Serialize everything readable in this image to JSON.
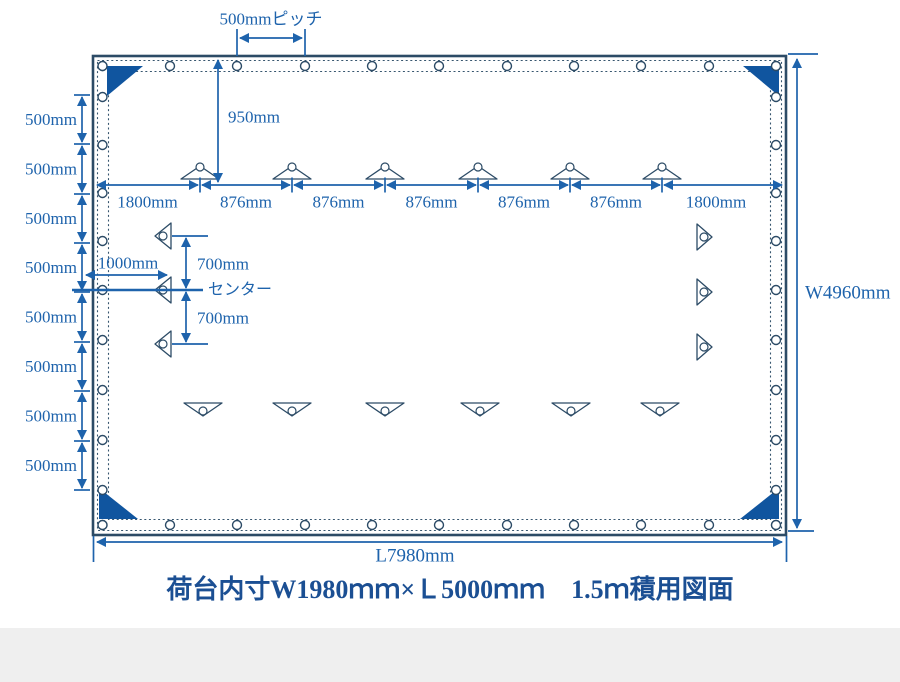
{
  "caption": {
    "text": "荷台内寸W1980ｍｍ×Ｌ5000ｍｍ　1.5ｍ積用図面"
  },
  "labels": {
    "pitch": "500mmピッチ",
    "drop": "950mm",
    "offset": "1000mm",
    "center": "センター",
    "width": "W4960mm",
    "length": "L7980mm"
  },
  "colors": {
    "outline": "#2c4b66",
    "dimension_blue": "#1e63ac",
    "corner_fill": "#10559f",
    "caption_blue": "#1b4f93",
    "bottom_band": "#efefef",
    "background": "#ffffff"
  },
  "top_dimension": {
    "y": 185,
    "start": 95,
    "end": 784,
    "ticks": [
      200,
      292,
      385,
      478,
      570,
      662
    ],
    "labels": [
      "1800mm",
      "876mm",
      "876mm",
      "876mm",
      "876mm",
      "876mm",
      "1800mm"
    ]
  },
  "left_chain": {
    "x": 82,
    "ticks": [
      95,
      144,
      194,
      243,
      292,
      342,
      391,
      441,
      490
    ],
    "labels": [
      "500mm",
      "500mm",
      "500mm",
      "500mm",
      "500mm",
      "500mm",
      "500mm",
      "500mm"
    ]
  },
  "vertical_700": {
    "labels": [
      "700mm",
      "700mm"
    ]
  },
  "grommets": {
    "top_y": 66,
    "bottom_y": 525,
    "left_x": 102.5,
    "right_x": 776,
    "x_positions": [
      102.5,
      170,
      237,
      305,
      372,
      439,
      507,
      574,
      641,
      709,
      776
    ],
    "y_positions": [
      66,
      97,
      145,
      193,
      241,
      290,
      340,
      390,
      440,
      490,
      525
    ]
  },
  "loops": {
    "top": {
      "cx": [
        200,
        292,
        385,
        478,
        570,
        662
      ],
      "base_y": 179,
      "apex_y": 166,
      "half": 19,
      "ring_y": 167
    },
    "bottom": {
      "cx": [
        203,
        292,
        385,
        480,
        571,
        660
      ],
      "base_y": 403,
      "apex_y": 416,
      "half": 19,
      "ring_y": 411
    },
    "left": {
      "cy": [
        236,
        290,
        344
      ],
      "base_x": 171,
      "apex_x": 155,
      "half": 13,
      "ring_x": 163
    },
    "right": {
      "cy": [
        237,
        292,
        347
      ],
      "base_x": 697,
      "apex_x": 712,
      "half": 13,
      "ring_x": 704
    }
  }
}
